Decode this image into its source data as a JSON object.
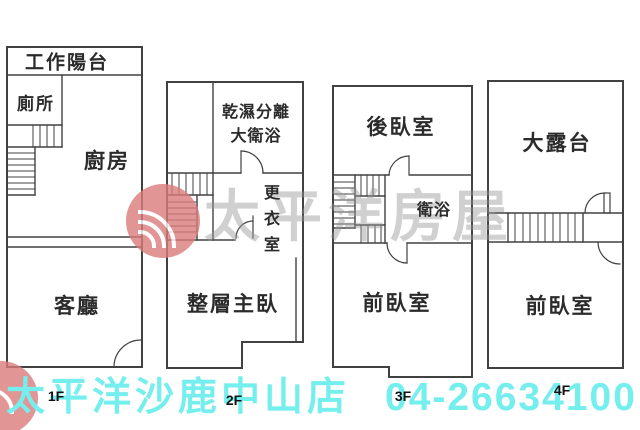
{
  "brand": {
    "watermark_text": "太平洋房屋",
    "logo": "pacific-rose-logo"
  },
  "footer": {
    "store_name": "太平洋沙鹿中山店",
    "phone": "04-26634100"
  },
  "floors": {
    "f1": {
      "label": "1F",
      "work_balcony": "工作陽台",
      "toilet": "廁所",
      "kitchen": "廚房",
      "living_room": "客廳"
    },
    "f2": {
      "label": "2F",
      "bathroom_line1": "乾濕分離",
      "bathroom_line2": "大衛浴",
      "dressing_room": "更衣室",
      "master_bedroom": "整層主臥"
    },
    "f3": {
      "label": "3F",
      "back_bedroom": "後臥室",
      "bathroom": "衛浴",
      "front_bedroom": "前臥室"
    },
    "f4": {
      "label": "4F",
      "terrace": "大露台",
      "front_bedroom": "前臥室"
    }
  },
  "colors": {
    "footer_text": "#75EEEE",
    "wall_line": "#414141",
    "watermark_text": "#9b9b9b",
    "logo_red": "#db7b7b"
  }
}
